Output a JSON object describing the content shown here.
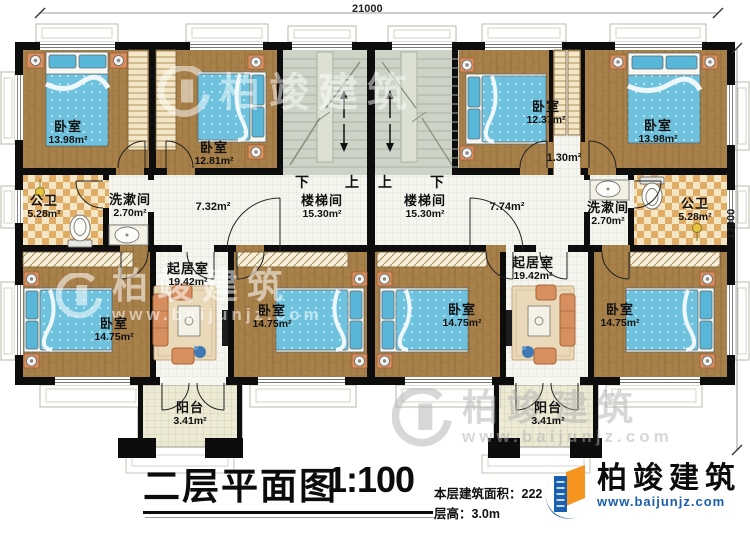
{
  "plan": {
    "dim_top": "21000",
    "dim_right": "12000",
    "stair": {
      "left_down": "下",
      "left_up": "上",
      "right_up": "上",
      "right_down": "下"
    },
    "rooms": {
      "bedroom_a": {
        "name": "卧室",
        "area": "13.98m²"
      },
      "bedroom_b": {
        "name": "卧室",
        "area": "12.81m²"
      },
      "toilet_l": {
        "name": "公卫",
        "area": "5.28m²"
      },
      "wash_l": {
        "name": "洗漱间",
        "area": "2.70m²"
      },
      "hall_l": {
        "area": "7.32m²"
      },
      "stair_l": {
        "name": "楼梯间",
        "area": "15.30m²"
      },
      "living_l": {
        "name": "起居室",
        "area": "19.42m²"
      },
      "bedroom_c": {
        "name": "卧室",
        "area": "14.75m²"
      },
      "bedroom_d": {
        "name": "卧室",
        "area": "14.75m²"
      },
      "balcony_l": {
        "name": "阳台",
        "area": "3.41m²"
      },
      "stair_r": {
        "name": "楼梯间",
        "area": "15.30m²"
      },
      "hall_r": {
        "area": "7.74m²"
      },
      "niche_r": {
        "area": "1.30m²"
      },
      "bedroom_e": {
        "name": "卧室",
        "area": "12.37m²"
      },
      "bedroom_f": {
        "name": "卧室",
        "area": "13.98m²"
      },
      "wash_r": {
        "name": "洗漱间",
        "area": "2.70m²"
      },
      "toilet_r": {
        "name": "公卫",
        "area": "5.28m²"
      },
      "living_r": {
        "name": "起居室",
        "area": "19.42m²"
      },
      "bedroom_r1": {
        "name": "卧室",
        "area": "14.75m²"
      },
      "bedroom_r2": {
        "name": "卧室",
        "area": "14.75m²"
      },
      "balcony_r": {
        "name": "阳台",
        "area": "3.41m²"
      }
    }
  },
  "title_block": {
    "title": "二层平面图",
    "scale": "1:100",
    "area_line": "本层建筑面积：222",
    "height_line": "层高：3.0m"
  },
  "logo": {
    "company": "柏竣建筑",
    "website": "www.baijunjz.com"
  },
  "watermark": {
    "company": "柏竣建筑",
    "website": "www.baijunjz.com"
  },
  "colors": {
    "wall": "#0d0d0d",
    "wood_floor": "#a8804a",
    "bed_blue": "#6fc2de",
    "stair_gray": "#cdd4c7",
    "bath_checker": "#e0ad66",
    "logo_blue": "#1a5fae",
    "logo_orange": "#f5941f"
  }
}
